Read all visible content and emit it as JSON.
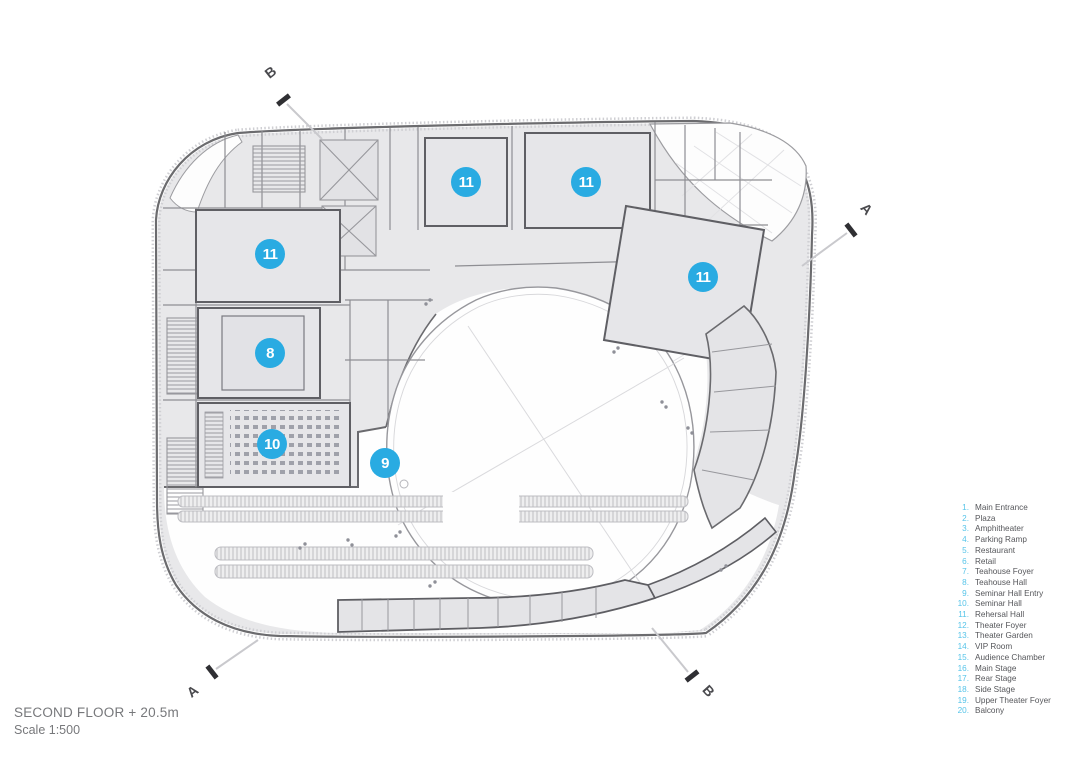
{
  "drawing": {
    "title": "SECOND FLOOR + 20.5m",
    "scale": "Scale 1:500"
  },
  "legend": {
    "items": [
      {
        "num": "1.",
        "label": "Main Entrance"
      },
      {
        "num": "2.",
        "label": "Plaza"
      },
      {
        "num": "3.",
        "label": "Amphitheater"
      },
      {
        "num": "4.",
        "label": "Parking Ramp"
      },
      {
        "num": "5.",
        "label": "Restaurant"
      },
      {
        "num": "6.",
        "label": "Retail"
      },
      {
        "num": "7.",
        "label": "Teahouse Foyer"
      },
      {
        "num": "8.",
        "label": "Teahouse Hall"
      },
      {
        "num": "9.",
        "label": "Seminar Hall Entry"
      },
      {
        "num": "10.",
        "label": "Seminar Hall"
      },
      {
        "num": "11.",
        "label": "Rehersal Hall"
      },
      {
        "num": "12.",
        "label": "Theater Foyer"
      },
      {
        "num": "13.",
        "label": "Theater Garden"
      },
      {
        "num": "14.",
        "label": "VIP Room"
      },
      {
        "num": "15.",
        "label": "Audience Chamber"
      },
      {
        "num": "16.",
        "label": "Main Stage"
      },
      {
        "num": "17.",
        "label": "Rear Stage"
      },
      {
        "num": "18.",
        "label": "Side Stage"
      },
      {
        "num": "19.",
        "label": "Upper Theater Foyer"
      },
      {
        "num": "20.",
        "label": "Balcony"
      }
    ]
  },
  "bubbles": [
    {
      "n": "11"
    },
    {
      "n": "11"
    },
    {
      "n": "11"
    },
    {
      "n": "11"
    },
    {
      "n": "8"
    },
    {
      "n": "10"
    },
    {
      "n": "9"
    }
  ],
  "sections": [
    {
      "letter": "B"
    },
    {
      "letter": "A"
    },
    {
      "letter": "A"
    },
    {
      "letter": "B"
    }
  ],
  "colors": {
    "marker_blue": "#29abe2",
    "legend_number_cyan": "#56c4e9",
    "legend_text_gray": "#58595b",
    "floor_fill": "#e8e8ea",
    "wall_dark": "#606065",
    "title_gray": "#77787b"
  }
}
